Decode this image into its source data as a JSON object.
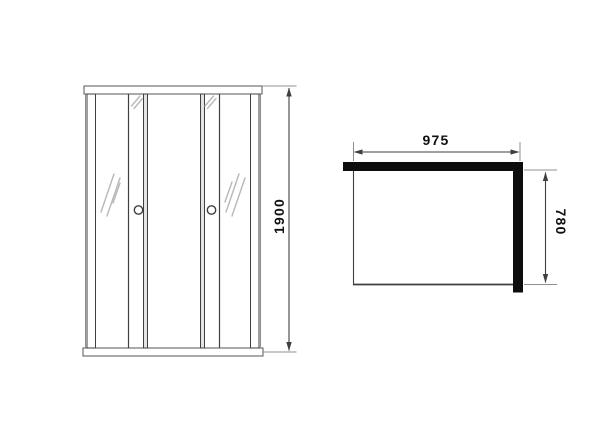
{
  "diagram": {
    "front_view": {
      "height_mm": "1900"
    },
    "top_view": {
      "width_mm": "975",
      "depth_mm": "780"
    }
  },
  "icons": {
    "handles": "round-knob",
    "reflections": "glass-shine-marks",
    "arrows": "dimension-arrowheads"
  },
  "colors": {
    "background": "#ffffff",
    "line": "#3f3f3f",
    "rail": "#555555",
    "extension_line": "#8f8f8f",
    "panel_black": "#0d0d0d",
    "reflection": "#b8b8b8",
    "text": "#101010"
  }
}
